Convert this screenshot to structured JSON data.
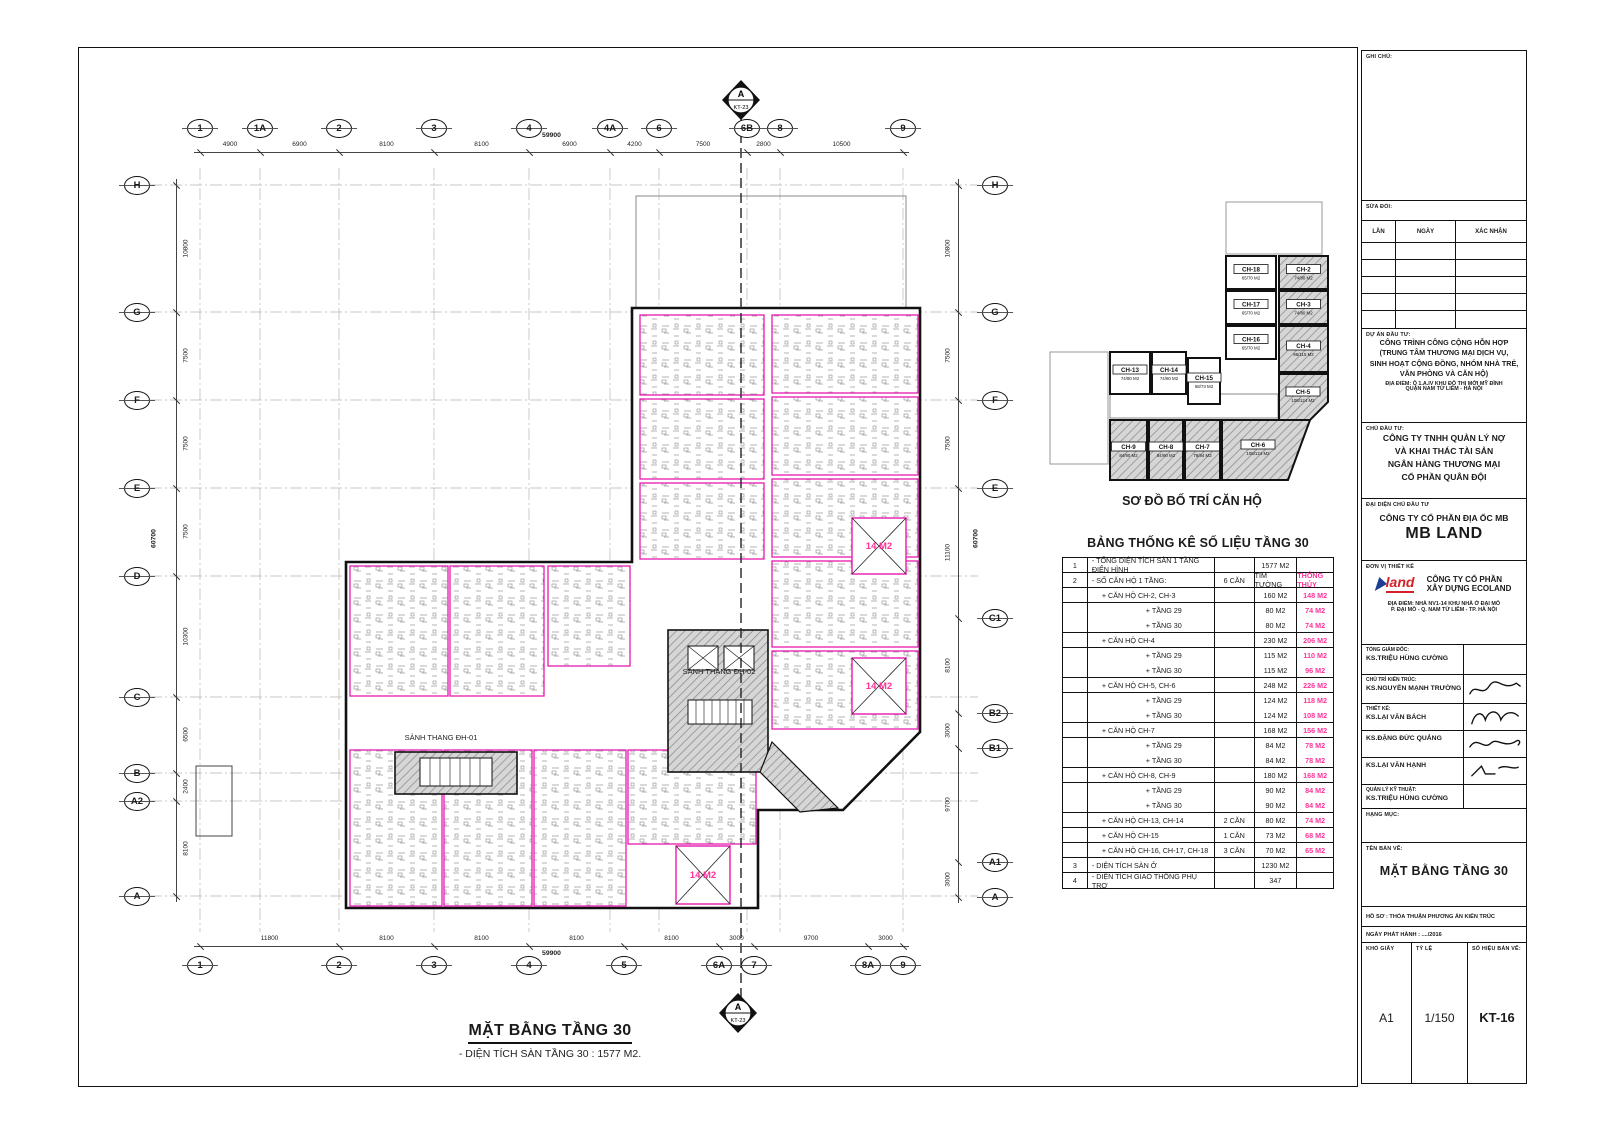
{
  "colors": {
    "magenta": "#e619ae",
    "pink": "#ff3399",
    "line": "#1a1a1a",
    "hatch_fill": "#d6d6d6",
    "hatch_line": "#8f8f8f",
    "logo_red": "#d42027",
    "logo_blue": "#1b3f94"
  },
  "sheet": {
    "plan_title": "MẶT BẰNG TẦNG 30",
    "plan_subtitle": "- DIỆN TÍCH SÀN TẦNG 30 : 1577 M2.",
    "section_letter": "A",
    "section_code": "KT-23"
  },
  "plan": {
    "lobby1": "SẢNH THANG ĐH-01",
    "lobby2": "SẢNH THANG ĐH-02",
    "void_label": "14 M2"
  },
  "grid": {
    "top": {
      "labels": [
        "1",
        "1A",
        "2",
        "3",
        "4",
        "4A",
        "6",
        "6B",
        "8",
        "9"
      ],
      "dims": [
        "4900",
        "6900",
        "8100",
        "8100",
        "6900",
        "4200",
        "7500",
        "2800",
        "10500"
      ],
      "total": "59900"
    },
    "bottom": {
      "labels": [
        "1",
        "2",
        "3",
        "4",
        "5",
        "6A",
        "7",
        "8A",
        "9"
      ],
      "dims": [
        "11800",
        "8100",
        "8100",
        "8100",
        "8100",
        "3000",
        "9700",
        "3000"
      ],
      "total": "59900"
    },
    "left": {
      "labels": [
        "H",
        "G",
        "F",
        "E",
        "D",
        "C",
        "B",
        "A2",
        "A"
      ],
      "dims": [
        "10800",
        "7500",
        "7500",
        "7500",
        "10300",
        "6500",
        "2400",
        "8100"
      ],
      "total": "60700"
    },
    "right": {
      "labels": [
        "H",
        "G",
        "F",
        "E",
        "C1",
        "B2",
        "B1",
        "A1",
        "A"
      ],
      "dims": [
        "10800",
        "7500",
        "7500",
        "11100",
        "8100",
        "3000",
        "9700",
        "3000"
      ],
      "total": "60700"
    }
  },
  "key_plan": {
    "title": "SƠ ĐỒ BỐ TRÍ CĂN HỘ",
    "units": [
      {
        "id": "CH-18",
        "area": "65/70 M2",
        "hatched": false
      },
      {
        "id": "CH-17",
        "area": "65/70 M2",
        "hatched": false
      },
      {
        "id": "CH-16",
        "area": "65/70 M2",
        "hatched": false
      },
      {
        "id": "CH-2",
        "area": "74/80 M2",
        "hatched": true
      },
      {
        "id": "CH-3",
        "area": "74/80 M2",
        "hatched": true
      },
      {
        "id": "CH-4",
        "area": "96/115 M2",
        "hatched": true
      },
      {
        "id": "CH-5",
        "area": "108/124 M2",
        "hatched": true
      },
      {
        "id": "CH-13",
        "area": "74/80 M2",
        "hatched": false
      },
      {
        "id": "CH-14",
        "area": "74/80 M2",
        "hatched": false
      },
      {
        "id": "CH-15",
        "area": "68/73 M2",
        "hatched": false
      },
      {
        "id": "CH-9",
        "area": "84/90 M2",
        "hatched": true
      },
      {
        "id": "CH-8",
        "area": "84/90 M2",
        "hatched": true
      },
      {
        "id": "CH-7",
        "area": "78/84 M2",
        "hatched": true
      },
      {
        "id": "CH-6",
        "area": "108/124 M2",
        "hatched": true
      }
    ]
  },
  "stats_table": {
    "title": "BẢNG THỐNG KÊ SỐ LIỆU TẦNG 30",
    "rows": [
      {
        "no": "1",
        "desc": "- TỔNG DIỆN TÍCH SÀN 1 TẦNG ĐIỂN HÌNH",
        "indent": 0,
        "count": "",
        "tim": "1577 M2",
        "thong": ""
      },
      {
        "no": "2",
        "desc": "- SỐ CĂN HỘ 1 TẦNG:",
        "indent": 0,
        "count": "6 CĂN",
        "tim": "TIM TƯỜNG",
        "thong": "THÔNG THỦY"
      },
      {
        "no": "",
        "desc": "+ CĂN HỘ CH-2, CH-3",
        "indent": 1,
        "count": "",
        "tim": "160 M2",
        "thong": "148 M2"
      },
      {
        "no": "",
        "desc": "+ TẦNG 29",
        "indent": 2,
        "count": "",
        "tim": "80 M2",
        "thong": "74 M2"
      },
      {
        "no": "",
        "desc": "+ TẦNG 30",
        "indent": 2,
        "count": "",
        "tim": "80 M2",
        "thong": "74 M2"
      },
      {
        "no": "",
        "desc": "+ CĂN HỘ CH-4",
        "indent": 1,
        "count": "",
        "tim": "230 M2",
        "thong": "206 M2"
      },
      {
        "no": "",
        "desc": "+ TẦNG 29",
        "indent": 2,
        "count": "",
        "tim": "115 M2",
        "thong": "110 M2"
      },
      {
        "no": "",
        "desc": "+ TẦNG 30",
        "indent": 2,
        "count": "",
        "tim": "115 M2",
        "thong": "96 M2"
      },
      {
        "no": "",
        "desc": "+ CĂN HỘ CH-5, CH-6",
        "indent": 1,
        "count": "",
        "tim": "248 M2",
        "thong": "226 M2"
      },
      {
        "no": "",
        "desc": "+ TẦNG 29",
        "indent": 2,
        "count": "",
        "tim": "124 M2",
        "thong": "118 M2"
      },
      {
        "no": "",
        "desc": "+ TẦNG 30",
        "indent": 2,
        "count": "",
        "tim": "124 M2",
        "thong": "108 M2"
      },
      {
        "no": "",
        "desc": "+ CĂN HỘ CH-7",
        "indent": 1,
        "count": "",
        "tim": "168 M2",
        "thong": "156 M2"
      },
      {
        "no": "",
        "desc": "+ TẦNG 29",
        "indent": 2,
        "count": "",
        "tim": "84 M2",
        "thong": "78 M2"
      },
      {
        "no": "",
        "desc": "+ TẦNG 30",
        "indent": 2,
        "count": "",
        "tim": "84 M2",
        "thong": "78 M2"
      },
      {
        "no": "",
        "desc": "+ CĂN HỘ CH-8, CH-9",
        "indent": 1,
        "count": "",
        "tim": "180 M2",
        "thong": "168 M2"
      },
      {
        "no": "",
        "desc": "+ TẦNG 29",
        "indent": 2,
        "count": "",
        "tim": "90 M2",
        "thong": "84 M2"
      },
      {
        "no": "",
        "desc": "+ TẦNG 30",
        "indent": 2,
        "count": "",
        "tim": "90 M2",
        "thong": "84 M2"
      },
      {
        "no": "",
        "desc": "+ CĂN HỘ CH-13, CH-14",
        "indent": 1,
        "count": "2 CĂN",
        "tim": "80 M2",
        "thong": "74 M2"
      },
      {
        "no": "",
        "desc": "+ CĂN HỘ CH-15",
        "indent": 1,
        "count": "1 CĂN",
        "tim": "73 M2",
        "thong": "68 M2"
      },
      {
        "no": "",
        "desc": "+ CĂN HỘ CH-16, CH-17, CH-18",
        "indent": 1,
        "count": "3 CĂN",
        "tim": "70 M2",
        "thong": "65 M2"
      },
      {
        "no": "3",
        "desc": "- DIỆN TÍCH SÀN Ở",
        "indent": 0,
        "count": "",
        "tim": "1230 M2",
        "thong": ""
      },
      {
        "no": "4",
        "desc": "- DIỆN TÍCH GIAO THÔNG PHỤ TRỢ",
        "indent": 0,
        "count": "",
        "tim": "347",
        "thong": ""
      }
    ]
  },
  "title_block": {
    "ghi_chu": "GHI CHÚ:",
    "sua_doi": "SỬA ĐỔI:",
    "rev_cols": [
      "LẦN",
      "NGÀY",
      "XÁC NHẬN"
    ],
    "du_an_label": "DỰ ÁN ĐẦU TƯ:",
    "du_an": [
      "CÔNG TRÌNH CÔNG CỘNG HỖN HỢP",
      "(TRUNG TÂM THƯƠNG MẠI DỊCH VỤ,",
      "SINH HOẠT CỘNG ĐỒNG, NHÓM NHÀ TRẺ,",
      "VĂN PHÒNG VÀ CĂN HỘ)"
    ],
    "dia_diem_1": [
      "ĐỊA ĐIỂM:  Ô 1.A.IV KHU ĐÔ THỊ MỚI MỸ ĐÌNH",
      "QUẬN NAM TỪ LIÊM - HÀ NỘI"
    ],
    "chu_dau_tu_label": "CHỦ ĐẦU TƯ:",
    "chu_dau_tu": [
      "CÔNG TY TNHH QUẢN LÝ NỢ",
      "VÀ KHAI THÁC TÀI SẢN",
      "NGÂN HÀNG THƯƠNG MẠI",
      "CỔ PHẦN QUÂN ĐỘI"
    ],
    "dai_dien_label": "ĐẠI DIỆN CHỦ ĐẦU TƯ",
    "dai_dien": "CÔNG TY CỔ PHẦN ĐỊA ỐC MB",
    "dai_dien_big": "MB LAND",
    "don_vi_label": "ĐƠN VỊ THIẾT KẾ",
    "ecoland_logo_word": "land",
    "ecoland": [
      "CÔNG TY CỔ PHẦN",
      "XÂY DỰNG ECOLAND"
    ],
    "dia_diem_2": [
      "ĐỊA ĐIỂM: NHÀ NV1-14 KHU NHÀ Ở ĐẠI MỖ",
      "P. ĐẠI MỖ - Q. NAM TỪ LIÊM - TP. HÀ NỘI"
    ],
    "roles": [
      {
        "label": "TỔNG GIÁM ĐỐC:",
        "name": "KS.TRIỆU HÙNG CƯỜNG",
        "sig": false
      },
      {
        "label": "CHỦ TRÌ KIẾN TRÚC:",
        "name": "KS.NGUYỄN MẠNH TRƯỜNG",
        "sig": true
      },
      {
        "label": "THIẾT KẾ:",
        "name": "KS.LẠI VĂN BÁCH",
        "sig": true
      },
      {
        "label": "",
        "name": "KS.ĐẶNG ĐỨC QUẢNG",
        "sig": true
      },
      {
        "label": "",
        "name": "KS.LẠI VĂN HẠNH",
        "sig": true
      },
      {
        "label": "QUẢN LÝ KỸ THUẬT:",
        "name": "KS.TRIỆU HÙNG CƯỜNG",
        "sig": false
      }
    ],
    "hang_muc": "HẠNG MỤC:",
    "ten_ban_ve_label": "TÊN BẢN VẼ:",
    "ten_ban_ve": "MẶT BẰNG TẦNG 30",
    "ho_so": "HỒ SƠ :   THỎA THUẬN PHƯƠNG ÁN KIẾN TRÚC",
    "ngay_phat_hanh": "NGÀY PHÁT HÀNH :   ..../2016",
    "kho_giay_label": "KHỔ GIẤY",
    "kho_giay": "A1",
    "ty_le_label": "TỶ LỆ",
    "ty_le": "1/150",
    "so_hieu_label": "SỐ HIỆU BẢN VẼ:",
    "so_hieu": "KT-16"
  }
}
